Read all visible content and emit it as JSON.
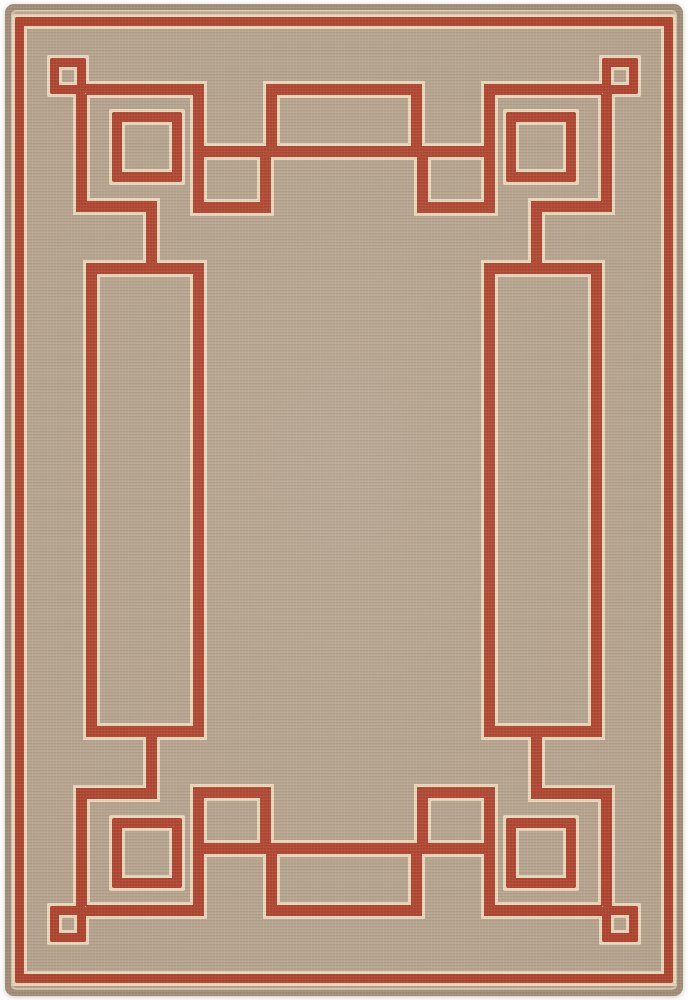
{
  "meta": {
    "description": "Product photograph of a rectangular flat-weave area rug. Plain warm-tan heathered field with a rust-red geometric Art Deco / Greek-key style border: an outer red pinstripe follows the rug edge; inside it, stepped corner motifs with a small open square in each corner, a larger halo-outlined square set diagonally inward at each corner, long inset frame lines with raised bridge rectangles centered on the short sides and pendant rectangles near the line ends, and doubled parallel rails along the long sides. All red lines are edged with a thin cream outline. Four-way mirror symmetry.",
    "object": "area rug",
    "orientation": "vertical rectangle",
    "canvas": {
      "width": 688,
      "height": 1000
    }
  },
  "colors": {
    "background_white": "#fdfdfd",
    "field_tan": "#b4a28d",
    "selvage_taupe": "#a08d79",
    "pattern_red": "#ae432e",
    "halo_cream": "#e7d6b9"
  },
  "pattern": {
    "canvas_w": 688,
    "canvas_h": 1000,
    "halo_expand": 3,
    "shapes": [
      {
        "name": "outer-border-frame",
        "type": "frame",
        "x": 15,
        "y": 17,
        "w": 658,
        "h": 966,
        "stroke": 9,
        "sym": "none"
      },
      {
        "name": "corner-small-square",
        "type": "frame",
        "x": 50,
        "y": 58,
        "w": 36,
        "h": 36,
        "stroke": 9,
        "sym": "both"
      },
      {
        "name": "corner-medium-square",
        "type": "frame",
        "x": 112,
        "y": 112,
        "w": 70,
        "h": 70,
        "stroke": 10,
        "sym": "both"
      },
      {
        "name": "corner-arm-horizontal",
        "type": "bar",
        "x": 86,
        "y": 84,
        "w": 118,
        "h": 11,
        "sym": "both"
      },
      {
        "name": "corner-step-vertical",
        "type": "bar",
        "x": 193,
        "y": 84,
        "w": 11,
        "h": 129,
        "sym": "both"
      },
      {
        "name": "pendant-bottom-bar",
        "type": "bar",
        "x": 193,
        "y": 202,
        "w": 78,
        "h": 11,
        "sym": "both"
      },
      {
        "name": "pendant-inner-vertical",
        "type": "bar",
        "x": 260,
        "y": 157,
        "w": 11,
        "h": 56,
        "sym": "both"
      },
      {
        "name": "corner-arm-vertical",
        "type": "bar",
        "x": 76,
        "y": 94,
        "w": 11,
        "h": 118,
        "sym": "both"
      },
      {
        "name": "corner-step-horizontal",
        "type": "bar",
        "x": 76,
        "y": 201,
        "w": 81,
        "h": 11,
        "sym": "both"
      },
      {
        "name": "side-upper-vertical",
        "type": "bar",
        "x": 146,
        "y": 201,
        "w": 11,
        "h": 73,
        "sym": "both"
      },
      {
        "name": "side-zigzag-bar",
        "type": "bar",
        "x": 91,
        "y": 263,
        "w": 113,
        "h": 11,
        "sym": "both"
      },
      {
        "name": "side-outer-long-vertical",
        "type": "bar",
        "x": 86,
        "y": 263,
        "w": 11,
        "h": 474,
        "sym": "x"
      },
      {
        "name": "inner-frame-vertical",
        "type": "bar",
        "x": 193,
        "y": 263,
        "w": 11,
        "h": 474,
        "sym": "x"
      },
      {
        "name": "inner-frame-horizontal",
        "type": "bar",
        "x": 193,
        "y": 146,
        "w": 302,
        "h": 11,
        "sym": "y"
      },
      {
        "name": "bridge-vertical",
        "type": "bar",
        "x": 266,
        "y": 84,
        "w": 11,
        "h": 73,
        "sym": "both"
      },
      {
        "name": "bridge-outer-bar",
        "type": "bar",
        "x": 266,
        "y": 84,
        "w": 156,
        "h": 11,
        "sym": "y"
      }
    ]
  }
}
